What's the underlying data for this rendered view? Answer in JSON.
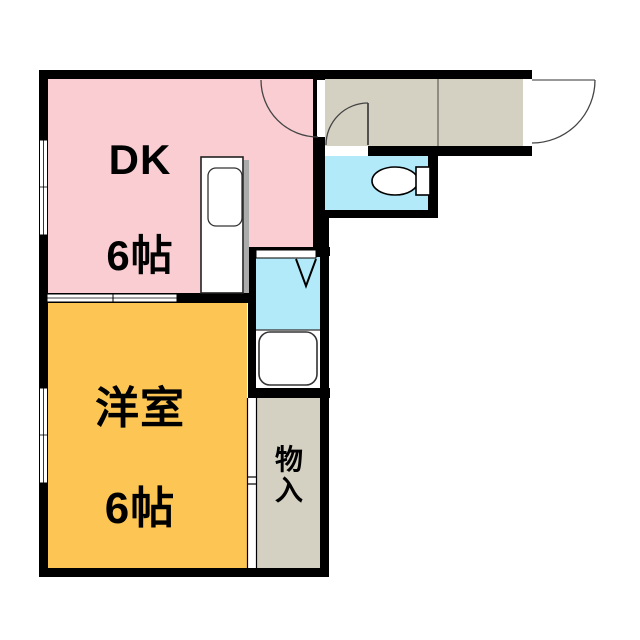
{
  "floorplan": {
    "rooms": {
      "dk": {
        "name": "DK",
        "size": "6帖"
      },
      "western": {
        "name": "洋室",
        "size": "6帖"
      },
      "storage": {
        "name": "物入"
      }
    },
    "colors": {
      "dk_room": "#F9CDD2",
      "western_room": "#FDC553",
      "hall_storage": "#D4D0C2",
      "water_rooms": "#B3EAF9",
      "wall": "#000000",
      "bg": "#FFFFFF",
      "fixture_outline": "#222222",
      "door_arc": "#444444"
    },
    "icons": {
      "toilet": "toilet-icon (ellipse bowl + tank rectangle)",
      "bathtub": "bathtub-icon (rounded rectangle)",
      "kitchen_sink": "kitchen-sink-icon (counter with rounded sink)",
      "washing_machine": "washing-machine-space-icon (V triangle)",
      "doors": "swing-door-arc-icon, sliding-door-icon, window-icon"
    }
  }
}
